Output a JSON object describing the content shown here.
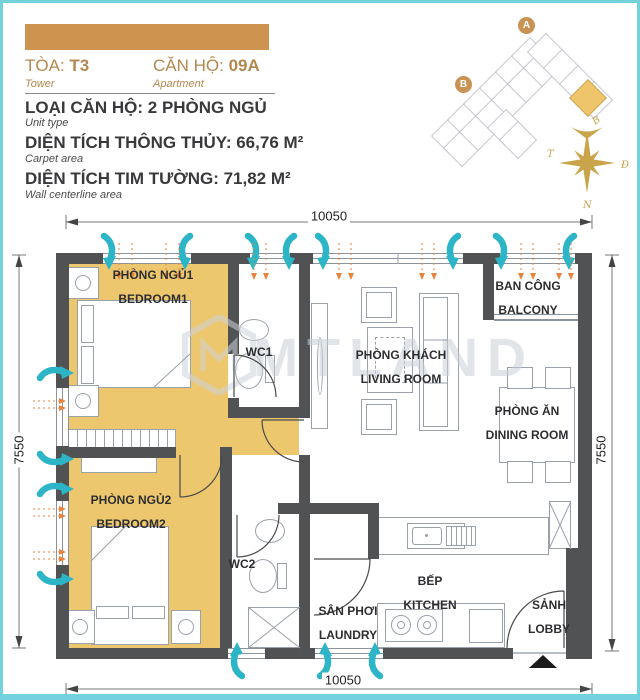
{
  "header": {
    "bar_color": "#cf9350",
    "tower_label": "TÒA:",
    "tower_value": "T3",
    "tower_sub": "Tower",
    "apartment_label": "CĂN HỘ:",
    "apartment_value": "09A",
    "apartment_sub": "Apartment",
    "unit_type": "LOẠI CĂN HỘ: 2 PHÒNG NGỦ",
    "unit_type_sub": "Unit type",
    "carpet_area": "DIỆN TÍCH THÔNG THỦY: 66,76 M²",
    "carpet_area_sub": "Carpet area",
    "centerline_area": "DIỆN TÍCH TIM TƯỜNG: 71,82 M²",
    "centerline_area_sub": "Wall centerline area"
  },
  "site_plan": {
    "marker_a": "A",
    "marker_b": "B",
    "compass": {
      "north": "B",
      "east": "Đ",
      "south": "N",
      "west": "T"
    }
  },
  "floor_plan": {
    "watermark": "MTLAND",
    "dimensions": {
      "top": "10050",
      "bottom": "10050",
      "left": "7550",
      "right": "7550"
    },
    "rooms": {
      "bedroom1": {
        "vn": "PHÒNG NGỦ1",
        "en": "BEDROOM1"
      },
      "wc1": {
        "vn": "WC1"
      },
      "living": {
        "vn": "PHÒNG KHÁCH",
        "en": "LIVING ROOM"
      },
      "balcony": {
        "vn": "BAN CÔNG",
        "en": "BALCONY"
      },
      "dining": {
        "vn": "PHÒNG ĂN",
        "en": "DINING ROOM"
      },
      "bedroom2": {
        "vn": "PHÒNG NGỦ2",
        "en": "BEDROOM2"
      },
      "wc2": {
        "vn": "WC2"
      },
      "laundry": {
        "vn": "SÂN PHƠI",
        "en": "LAUNDRY"
      },
      "kitchen": {
        "vn": "BẾP",
        "en": "KITCHEN"
      },
      "lobby": {
        "vn": "SẢNH",
        "en": "LOBBY"
      }
    }
  },
  "colors": {
    "accent_gold": "#edc76e",
    "wall": "#515254",
    "teal": "#2cb5c6",
    "orange": "#e8833c",
    "frame": "#74d2de",
    "header_bar": "#cf9350"
  }
}
